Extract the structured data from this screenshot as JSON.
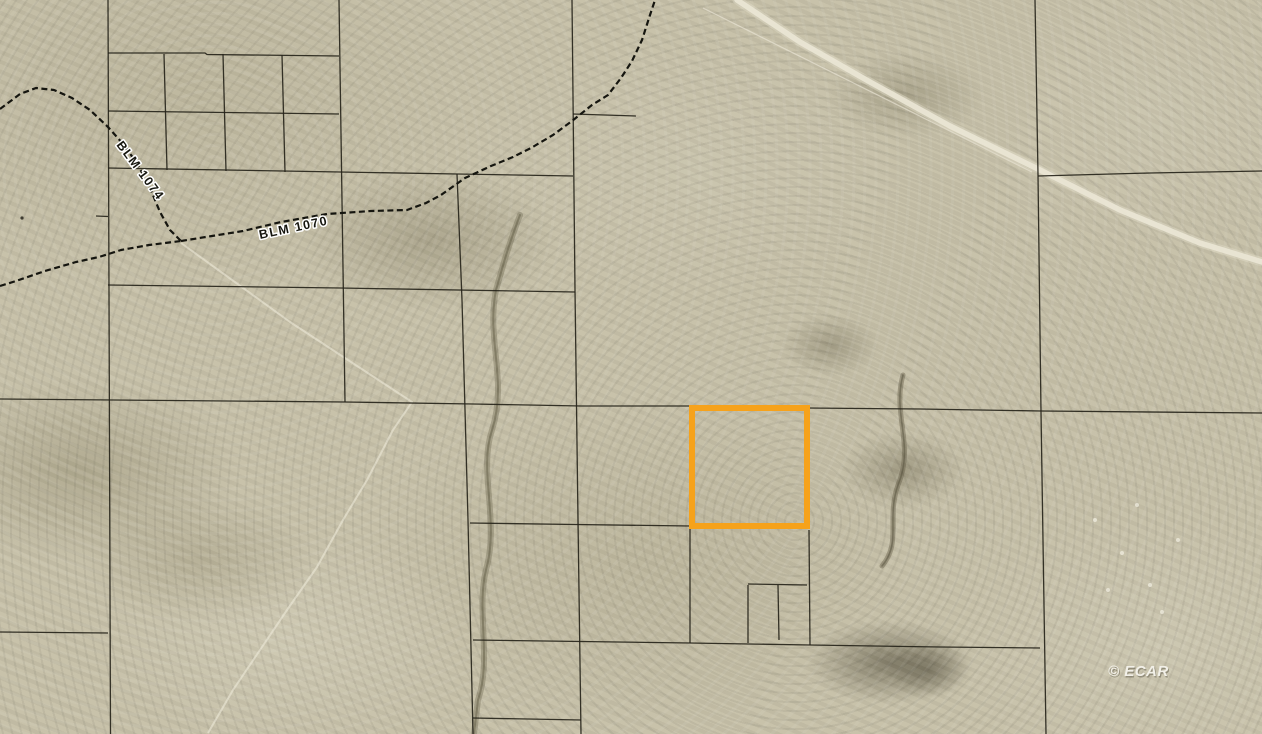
{
  "map": {
    "type": "aerial-parcel-map",
    "watermark": "© ECAR",
    "road_labels": [
      {
        "id": "blm-1074",
        "text": "BLM 1074"
      },
      {
        "id": "blm-1070",
        "text": "BLM 1070"
      }
    ],
    "highlighted_parcel": {
      "shape": "rectangle",
      "approx_px": {
        "x": 692,
        "y": 408,
        "w": 115,
        "h": 118
      }
    },
    "colors": {
      "terrain_base": "#c6c0a8",
      "terrain_light": "#d8d3bd",
      "terrain_dark": "#a29b80",
      "parcel_line": "#26241a",
      "road_line": "#15150f",
      "gravel_road": "#eae6d5",
      "track": "#f0eddd",
      "highlight": "#f6a21b",
      "label_text": "#16160f",
      "label_halo": "#ffffff",
      "watermark_color": "#f2f0e8"
    }
  }
}
